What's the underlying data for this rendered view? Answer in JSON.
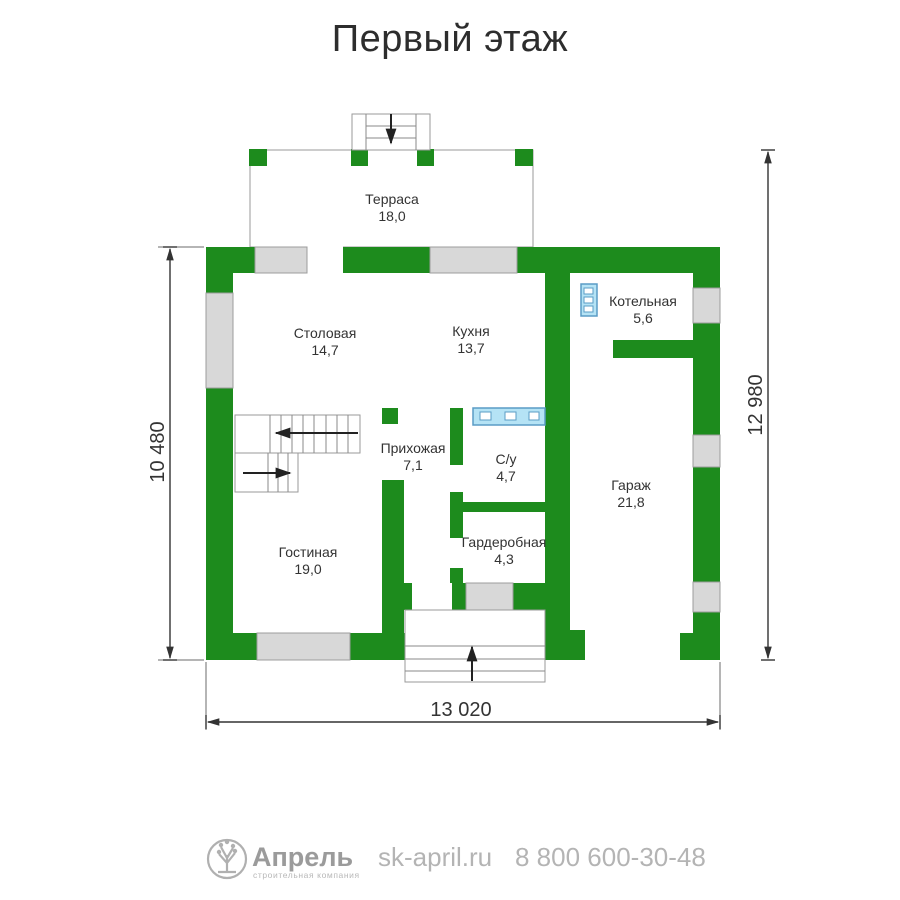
{
  "title": "Первый этаж",
  "plan": {
    "rooms": [
      {
        "name": "Терраса",
        "area": "18,0"
      },
      {
        "name": "Столовая",
        "area": "14,7"
      },
      {
        "name": "Кухня",
        "area": "13,7"
      },
      {
        "name": "Котельная",
        "area": "5,6"
      },
      {
        "name": "Прихожая",
        "area": "7,1"
      },
      {
        "name": "С/у",
        "area": "4,7"
      },
      {
        "name": "Гараж",
        "area": "21,8"
      },
      {
        "name": "Гардеробная",
        "area": "4,3"
      },
      {
        "name": "Гостиная",
        "area": "19,0"
      }
    ],
    "dimensions": {
      "left": "10 480",
      "right": "12 980",
      "bottom": "13 020"
    }
  },
  "colors": {
    "wall": "#1d8b1d",
    "window": "#d8d8d8",
    "fixture_fill": "#b5e3f5",
    "fixture_stroke": "#5a9cc5",
    "dimension": "#333333"
  },
  "footer": {
    "brand": "Апрель",
    "tagline": "строительная компания",
    "website": "sk-april.ru",
    "phone": "8 800 600-30-48"
  }
}
